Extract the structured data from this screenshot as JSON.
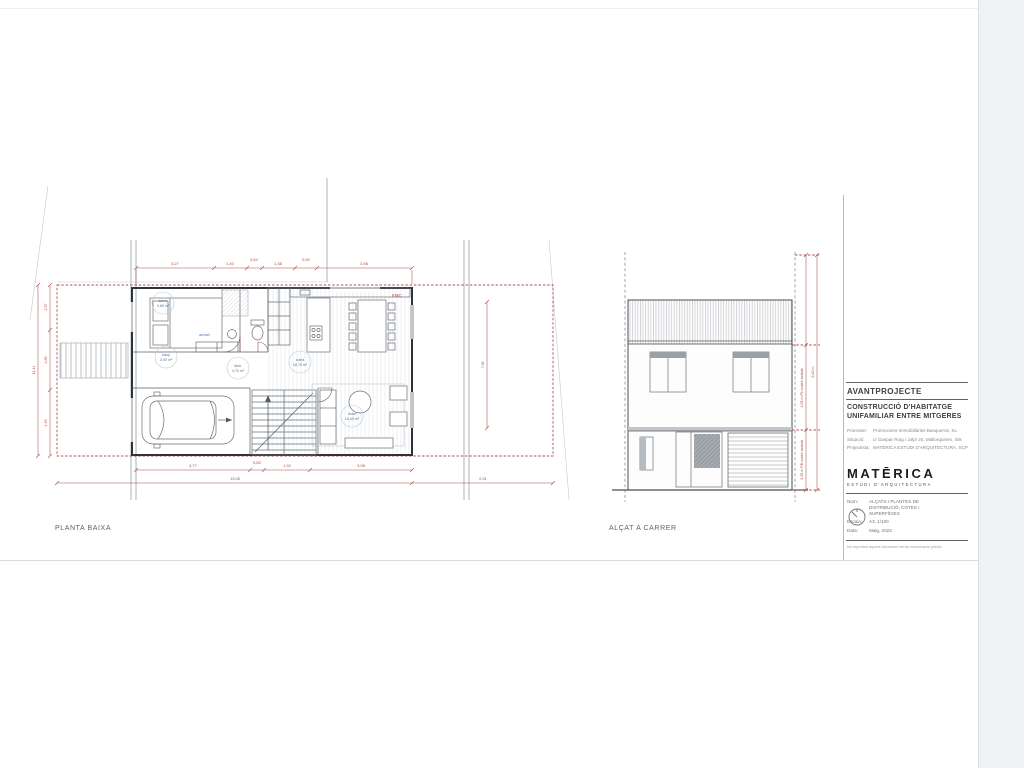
{
  "colors": {
    "accent_red": "#a94a44",
    "tag_blue": "#4a78a8",
    "line_gray": "#8a8f98"
  },
  "labels": {
    "plan": "PLANTA BAIXA",
    "elevation": "ALÇAT A CARRER"
  },
  "plan": {
    "tag_emc": "EMC",
    "annotation_armari": "armari",
    "room_tags": [
      {
        "name": "dorm.",
        "area": "9,85 m²"
      },
      {
        "name": "bany",
        "area": "3,90 m²"
      },
      {
        "name": "distr.",
        "area": "4,70 m²"
      },
      {
        "name": "cuina",
        "area": "18,75 m²"
      },
      {
        "name": "estar",
        "area": "16,40 m²"
      }
    ],
    "dims": {
      "top": [
        "3,27",
        "1,40",
        "0,64",
        "1,38",
        "0,92",
        "3,98"
      ],
      "bottom": [
        "4,77",
        "0,60",
        "1,92",
        "3,98"
      ],
      "bottom_total": "13,05",
      "bottom_right": "2,31",
      "left": [
        "2,97",
        "2,85",
        "4,45"
      ],
      "left_total": "11,14",
      "right": "7,06"
    }
  },
  "elevation": {
    "dims": {
      "p1": "3,05 m P1 sostre acabat",
      "pb": "3,35 m PB sostre acabat",
      "total": "6,40 m"
    }
  },
  "titleblock": {
    "phase": "AVANTPROJECTE",
    "project_line1": "CONSTRUCCIÓ D'HABITATGE",
    "project_line2": "UNIFAMILIAR ENTRE MITGERES",
    "meta": [
      {
        "label": "Promotor:",
        "value": "Promocions Immobiliàries Basqueros, SL"
      },
      {
        "label": "Situació:",
        "value": "c/ Gaspar Roig i Jalpí 20, Mallorquines, Sils"
      },
      {
        "label": "Projectista:",
        "value": "MATÈRICA ESTUDI D'ARQUITECTURA, SCP"
      }
    ],
    "logo_name": "MATĒRICA",
    "logo_tagline": "ESTUDI D'ARQUITECTURA",
    "info": [
      {
        "label": "Nom:",
        "value": "ALÇATS I PLANTES DE DISTRIBUCIÓ, COTES I SUPERFÍCIES"
      },
      {
        "label": "Escala:",
        "value": "A3, 1/100"
      },
      {
        "label": "Data:",
        "value": "Maig, 2023"
      }
    ],
    "disclaimer": "No reproduir aquest document sense autorització prèvia."
  }
}
